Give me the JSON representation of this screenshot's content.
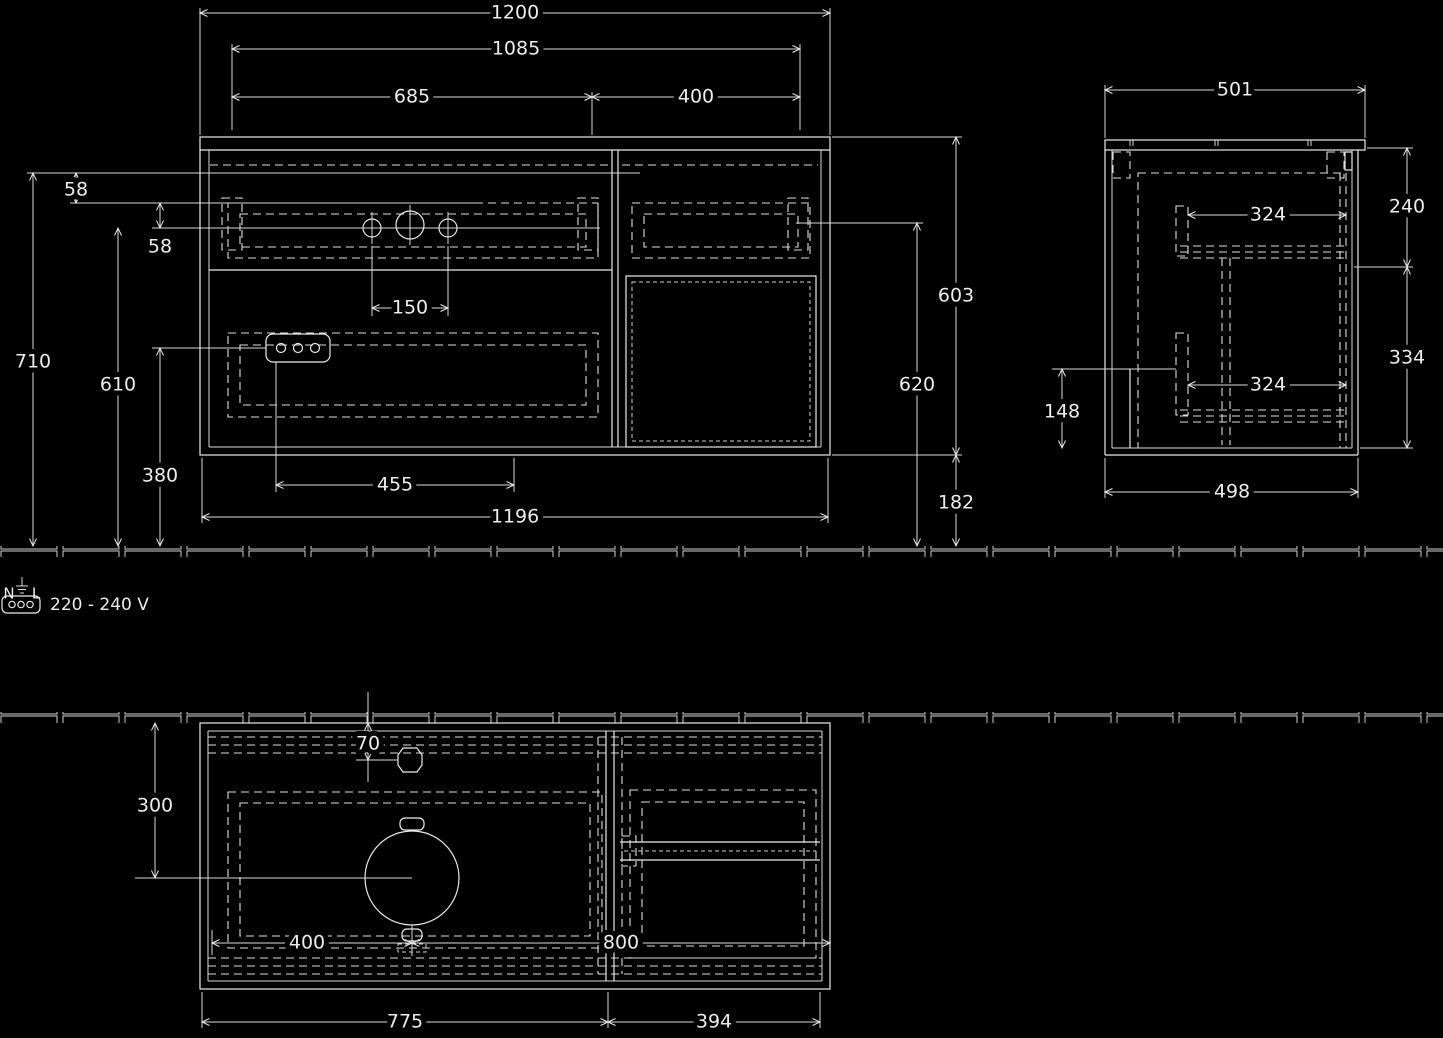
{
  "colors": {
    "background": "#000000",
    "line": "#ececec"
  },
  "power": {
    "n": "N",
    "l": "L",
    "label": "220 - 240 V"
  },
  "front_view": {
    "dims": {
      "total_width": "1200",
      "inner_width": "1085",
      "left_width": "685",
      "right_width": "400",
      "top_offset_1": "58",
      "top_offset_2": "58",
      "tap_hole_spacing": "150",
      "height_top": "710",
      "height_holes": "610",
      "height_socket": "380",
      "socket_span": "455",
      "body_width": "1196",
      "cabinet_height": "603",
      "mid_height": "620",
      "bottom_gap": "182"
    }
  },
  "side_view": {
    "dims": {
      "total_depth": "501",
      "upper_height": "240",
      "upper_depth": "324",
      "lower_height": "334",
      "lower_depth": "324",
      "recess_height": "148",
      "body_depth": "498"
    }
  },
  "plan_view": {
    "dims": {
      "tap_offset": "70",
      "drain_offset": "300",
      "drain_left": "400",
      "drain_right": "800",
      "left_width": "775",
      "right_width": "394"
    }
  }
}
